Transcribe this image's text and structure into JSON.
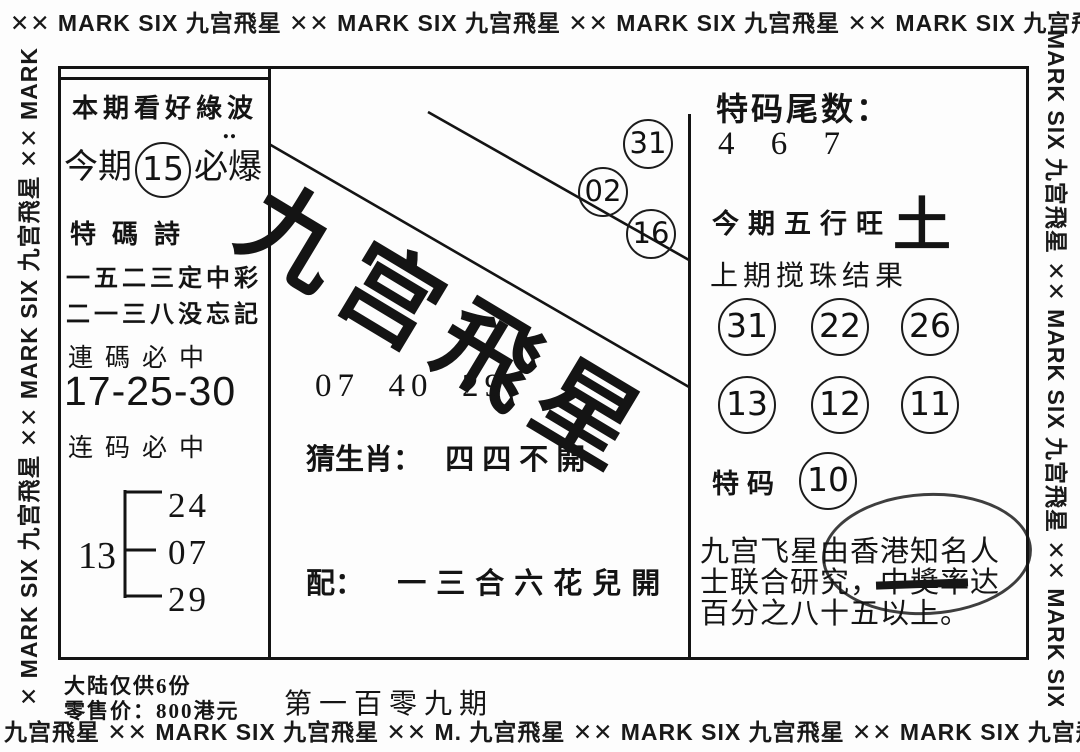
{
  "page": {
    "paper": "#fdfdfd",
    "ink": "#141414"
  },
  "borders": {
    "top_text": "✕✕ MARK SIX 九宫飛星 ✕✕ MARK SIX 九宫飛星 ✕✕ MARK SIX 九宫飛星 ✕✕ MARK SIX 九宫飛星 ✕✕",
    "bottom_text": "九宫飛星 ✕✕ MARK SIX 九宫飛星 ✕✕ M. 九宫飛星 ✕✕ MARK SIX 九宫飛星 ✕✕ MARK SIX 九宫飛星 ✕✕",
    "left_text": "✕ MARK SIX 九宫飛星 ✕✕ MARK SIX 九宫飛星 ✕✕ MARK SIX 九宫飛星 ✕",
    "right_text": "MARK SIX 九宫飛星 ✕✕ MARK SIX 九宫飛星 ✕✕ MARK SIX 九宫飛星 ✕"
  },
  "left_panel": {
    "headline": "本期看好綠波",
    "dots": "‥",
    "hot_prefix": "今期",
    "hot_number": "15",
    "hot_suffix": "必爆",
    "poem_title": "特碼詩",
    "poem_line1": "一五二三定中彩",
    "poem_line2": "二一三八没忘記",
    "combo_title1": "連碼必中",
    "combo_numbers": "17-25-30",
    "combo_title2": "连码必中",
    "tree": {
      "root": "13",
      "branches": [
        "24",
        "07",
        "29"
      ]
    }
  },
  "center_panel": {
    "calligraphy": "九宫飛星",
    "floating_circles": [
      "31",
      "02",
      "16"
    ],
    "numbers_row": "07  40  29",
    "zodiac_label": "猜生肖：",
    "zodiac_value": "四四不開",
    "pair_label": "配：",
    "pair_value": "一三合六花兒開"
  },
  "right_panel": {
    "tail_label": "特码尾数：",
    "tail_numbers": "4 6 7",
    "element_label": "今期五行旺",
    "element_value": "土",
    "last_draw_label": "上期搅珠结果",
    "draw_row1": [
      "31",
      "22",
      "26"
    ],
    "draw_row2": [
      "13",
      "12",
      "11"
    ],
    "special_label": "特码",
    "special_number": "10",
    "footer_line1": "九宫飞星由香港知名人",
    "footer_line2": "士联合研究，中獎率达",
    "footer_line3": "百分之八十五以上。"
  },
  "footer": {
    "note1": "大陆仅供6份",
    "note2": "零售价：800港元",
    "issue": "第一百零九期"
  }
}
